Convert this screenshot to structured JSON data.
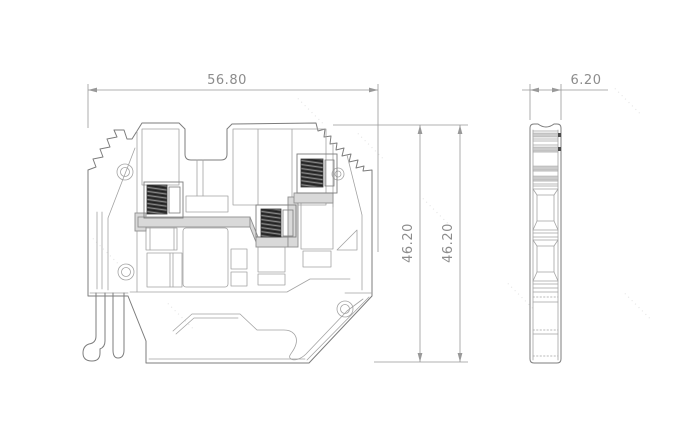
{
  "dimensions": {
    "width": {
      "label": "56.80"
    },
    "height_outer": {
      "label": "46.20"
    },
    "height_total": {
      "label": "46.20"
    },
    "thickness": {
      "label": "6.20"
    }
  },
  "watermark": {
    "text": "········"
  },
  "colors": {
    "line": "#7d7d7d",
    "line-light": "#a3a3a3",
    "dim": "#999999",
    "text": "#8c8c8c",
    "screw": "#3e3e3e",
    "busbar": "#d9d9d9",
    "band": "#cccccc",
    "watermark": "#e3e3e3",
    "bg": "#ffffff"
  }
}
